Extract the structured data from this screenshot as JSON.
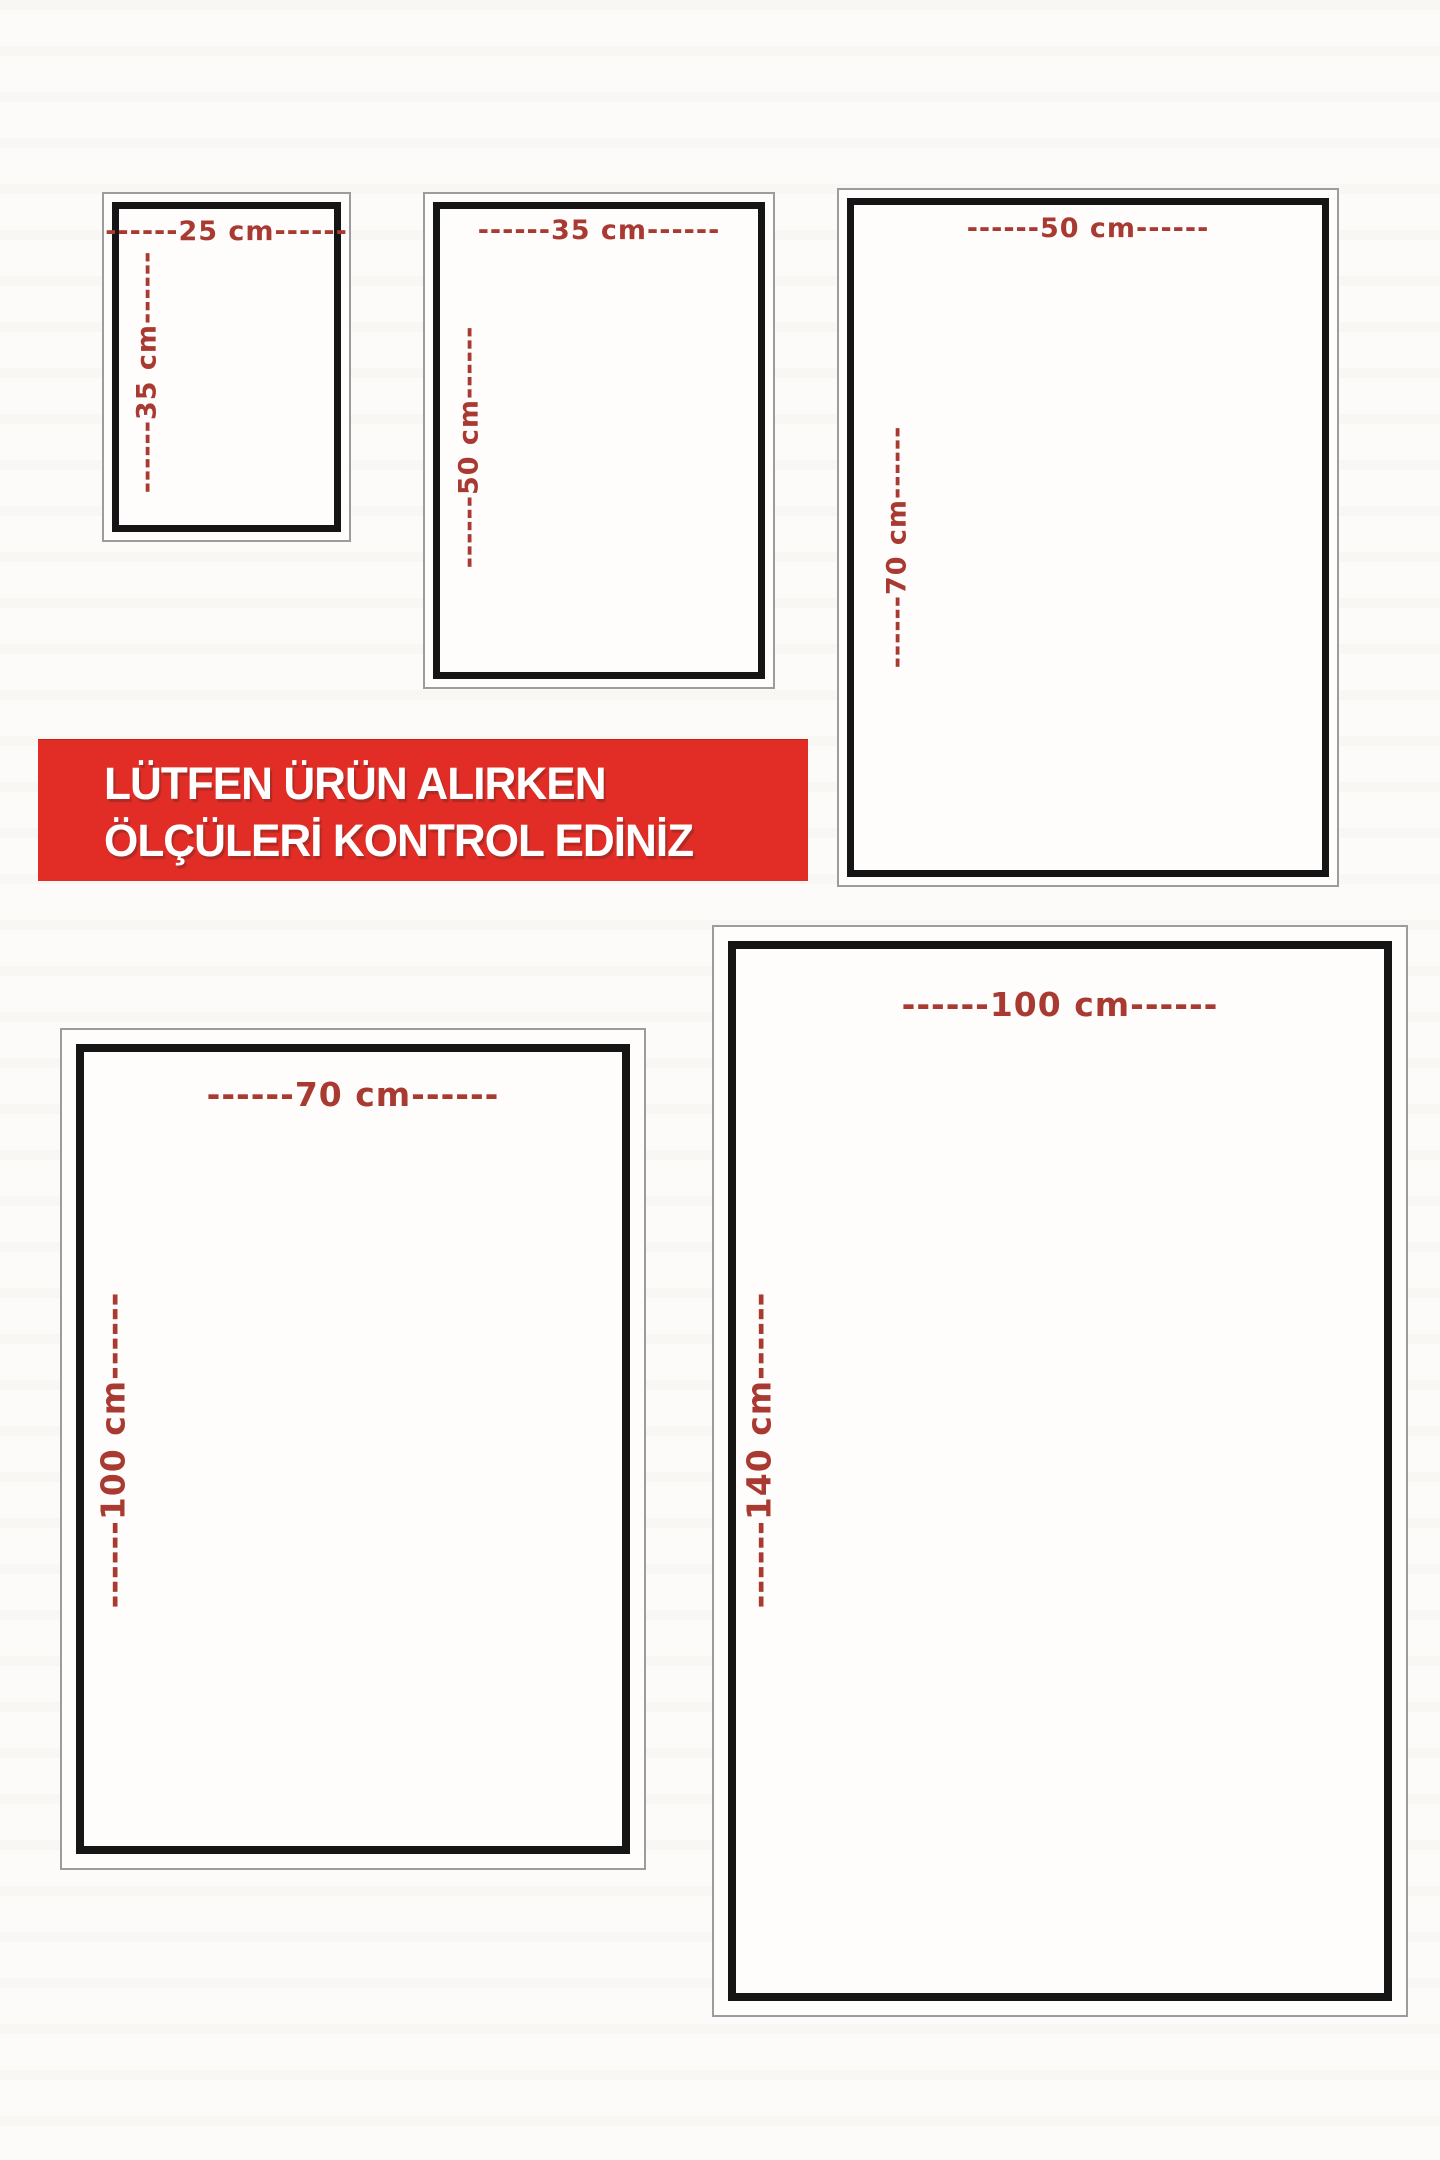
{
  "banner": {
    "line1": "LÜTFEN ÜRÜN ALIRKEN",
    "line2": "ÖLÇÜLERİ KONTROL EDİNİZ"
  },
  "sizes": [
    {
      "name": "25x35",
      "width_cm": 25,
      "height_cm": 35,
      "width_label": "------25 cm------",
      "height_label": "------35 cm------"
    },
    {
      "name": "35x50",
      "width_cm": 35,
      "height_cm": 50,
      "width_label": "------35 cm------",
      "height_label": "------50 cm------"
    },
    {
      "name": "50x70",
      "width_cm": 50,
      "height_cm": 70,
      "width_label": "------50 cm------",
      "height_label": "------70 cm------"
    },
    {
      "name": "70x100",
      "width_cm": 70,
      "height_cm": 100,
      "width_label": "------70 cm------",
      "height_label": "------100 cm------"
    },
    {
      "name": "100x140",
      "width_cm": 100,
      "height_cm": 140,
      "width_label": "------100 cm------",
      "height_label": "------140 cm------"
    }
  ],
  "colors": {
    "banner_red": "#e22d26",
    "label_red": "#a83a32",
    "frame_black": "#151515",
    "frame_gray": "#9c9c9c",
    "background": "#fcfbf9"
  }
}
